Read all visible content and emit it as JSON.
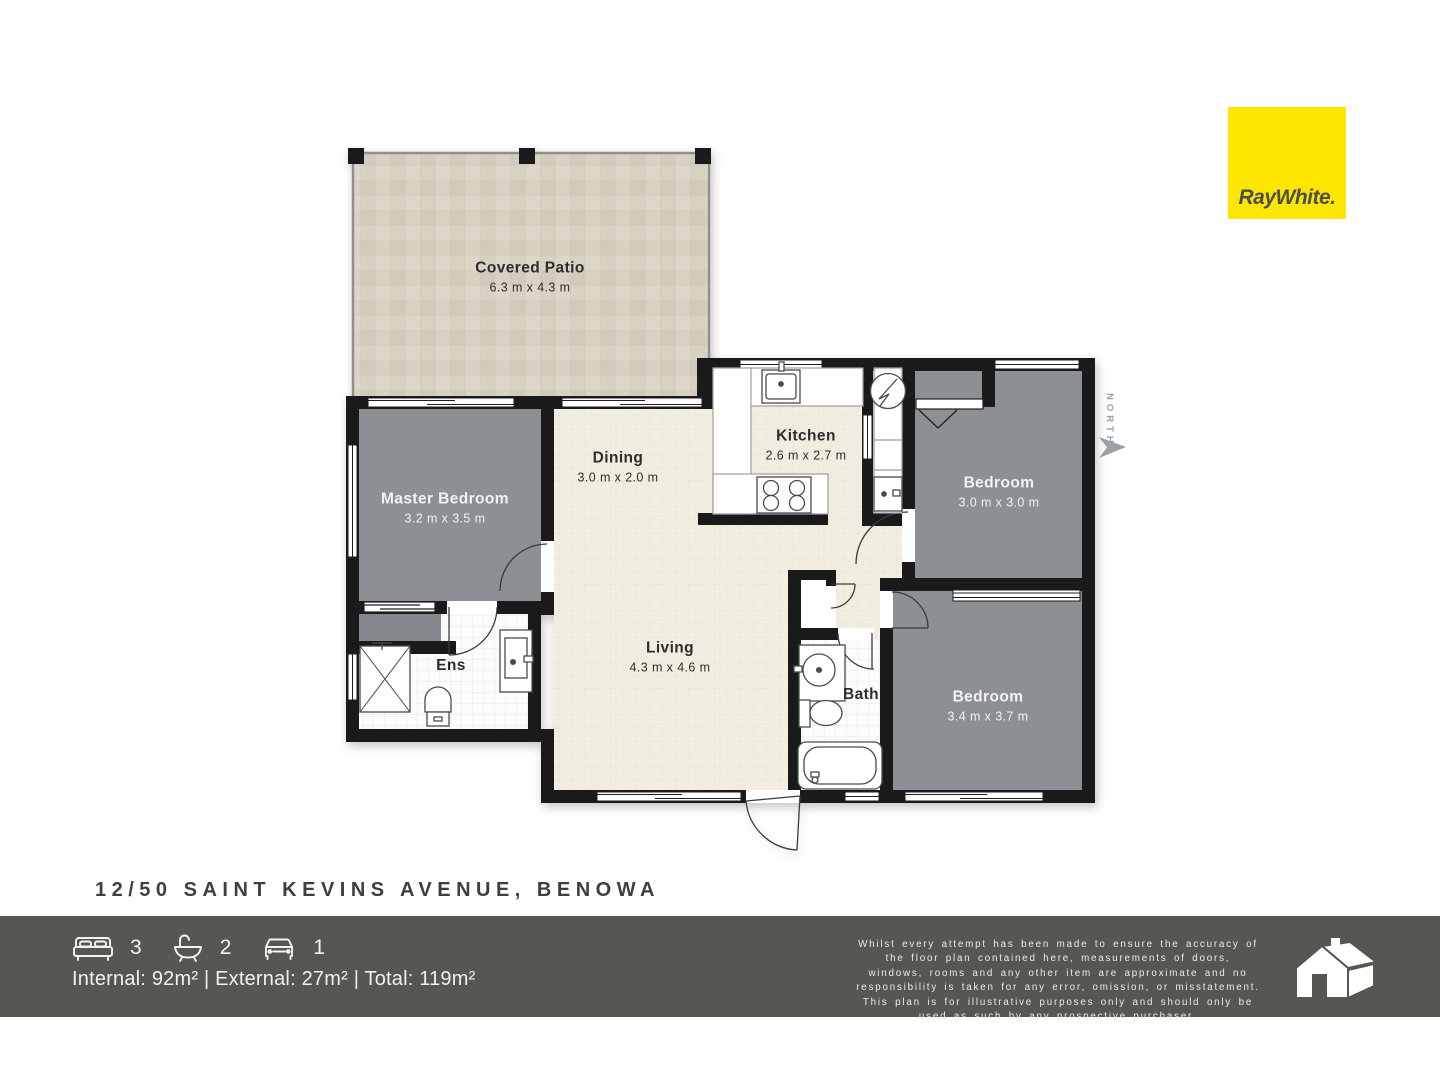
{
  "plan": {
    "north_label": "NORTH",
    "rooms": [
      {
        "name": "Covered Patio",
        "dims": "6.3 m x 4.3 m"
      },
      {
        "name": "Master Bedroom",
        "dims": "3.2 m x 3.5 m"
      },
      {
        "name": "Dining",
        "dims": "3.0 m x 2.0 m"
      },
      {
        "name": "Kitchen",
        "dims": "2.6 m x 2.7 m"
      },
      {
        "name": "Bedroom",
        "dims": "3.0 m x 3.0 m"
      },
      {
        "name": "Living",
        "dims": "4.3 m x 4.6 m"
      },
      {
        "name": "Bedroom",
        "dims": "3.4 m x 3.7 m"
      },
      {
        "name": "Ens"
      },
      {
        "name": "Bath"
      }
    ],
    "colors": {
      "wall": "#1a1a1a",
      "carpet": "#8c9095",
      "floor": "#f1ede1",
      "patio": "#d8d2c3",
      "tile": "#fcfcfb"
    }
  },
  "branding": {
    "logo_text": "RayWhite.",
    "logo_bg": "#ffe600"
  },
  "address": "12/50 SAINT KEVINS AVENUE, BENOWA",
  "footer": {
    "bg": "#575650",
    "stats": {
      "beds": "3",
      "baths": "2",
      "cars": "1"
    },
    "areas": "Internal: 92m² | External: 27m² | Total: 119m²",
    "disclaimer": "Whilst every attempt has been made to ensure the accuracy of the floor plan contained here, measurements of doors, windows, rooms and any other item are approximate and no responsibility is taken for any error, omission, or misstatement. This plan is for illustrative purposes only and should only be used as such by any prospective purchaser."
  }
}
